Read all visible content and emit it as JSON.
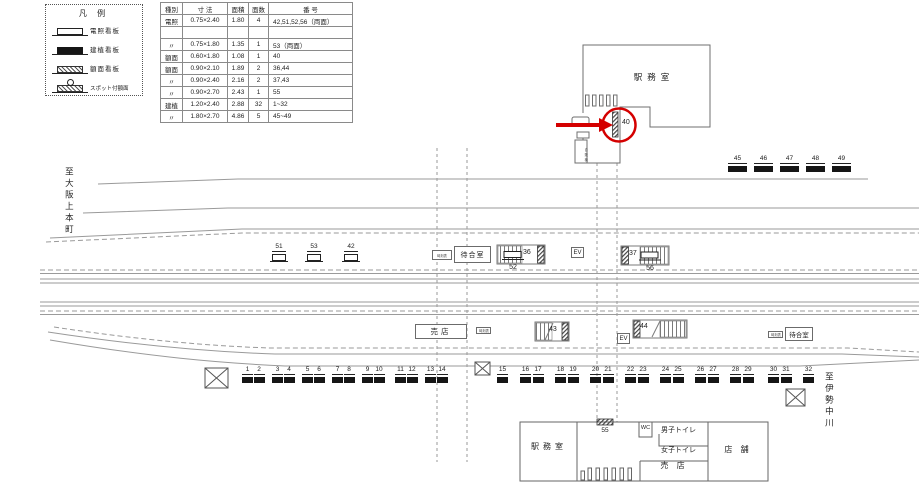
{
  "legend": {
    "title": "凡 例",
    "items": [
      {
        "label": "電照看板",
        "icon": "illuminated-sign-icon"
      },
      {
        "label": "建植看板",
        "icon": "built-sign-icon"
      },
      {
        "label": "額面看板",
        "icon": "panel-sign-icon"
      },
      {
        "label": "スポット付額面",
        "icon": "spotlight-panel-sign-icon"
      }
    ]
  },
  "spec_table": {
    "headers": [
      "種別",
      "寸 法",
      "面積",
      "面数",
      "番  号"
    ],
    "rows": [
      [
        "電照",
        "0.75×2.40",
        "1.80",
        "4",
        "42,51,52,56（両面）"
      ],
      [
        "",
        "",
        "",
        "",
        ""
      ],
      [
        "〃",
        "0.75×1.80",
        "1.35",
        "1",
        "53（両面）"
      ],
      [
        "額面",
        "0.60×1.80",
        "1.08",
        "1",
        "40"
      ],
      [
        "額面",
        "0.90×2.10",
        "1.89",
        "2",
        "36,44"
      ],
      [
        "〃",
        "0.90×2.40",
        "2.16",
        "2",
        "37,43"
      ],
      [
        "〃",
        "0.90×2.70",
        "2.43",
        "1",
        "55"
      ],
      [
        "建植",
        "1.20×2.40",
        "2.88",
        "32",
        "1~32"
      ],
      [
        "〃",
        "1.80×2.70",
        "4.86",
        "5",
        "45~49"
      ]
    ]
  },
  "directions": {
    "left": "至大阪上本町",
    "right": "至伊勢中川"
  },
  "station": {
    "top_office": "駅務室",
    "bottom_office": "駅務室",
    "wc": "WC",
    "mens_toilet": "男子トイレ",
    "womens_toilet": "女子トイレ",
    "kiosk_building": "売 店",
    "shop": "店 舗",
    "vending_machine": "自販機",
    "waiting_room_1": "待合室",
    "waiting_room_2": "待合室",
    "kiosk_platform": "売店",
    "elevator": "EV",
    "notice_box": "時刻表"
  },
  "signs": {
    "circled": "40",
    "s51": "51",
    "s53": "53",
    "s42": "42",
    "s52": "52",
    "s36": "36",
    "s37": "37",
    "s56": "56",
    "s43": "43",
    "s44": "44",
    "s55": "55",
    "top_right_row": [
      "45",
      "46",
      "47",
      "48",
      "49"
    ],
    "bottom_row": [
      "1",
      "2",
      "3",
      "4",
      "5",
      "6",
      "7",
      "8",
      "9",
      "10",
      "11",
      "12",
      "13",
      "14",
      "15",
      "16",
      "17",
      "18",
      "19",
      "20",
      "21",
      "22",
      "23",
      "24",
      "25",
      "26",
      "27",
      "28",
      "29",
      "30",
      "31",
      "32"
    ]
  },
  "colors": {
    "annotation_red": "#d40000",
    "track_line": "#9a9a9a",
    "sign_black": "#161616"
  }
}
